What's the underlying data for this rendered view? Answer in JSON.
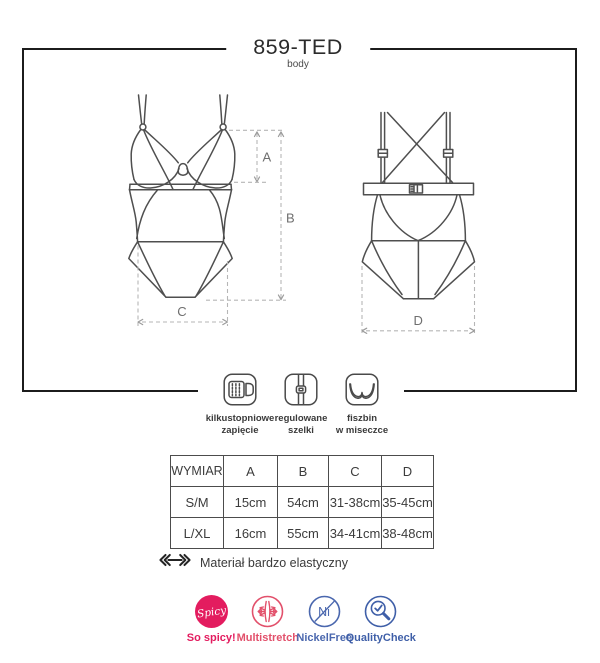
{
  "title": {
    "code": "859-TED",
    "subtitle": "body"
  },
  "dimensions": {
    "a": "A",
    "b": "B",
    "c": "C",
    "d": "D"
  },
  "features": [
    {
      "icon": "hook-eye-closure-icon",
      "line1": "kilkustopniowe",
      "line2": "zapięcie"
    },
    {
      "icon": "adjustable-straps-icon",
      "line1": "regulowane",
      "line2": "szelki"
    },
    {
      "icon": "underwire-cup-icon",
      "line1": "fiszbin",
      "line2": "w miseczce"
    }
  ],
  "size_table": {
    "headers": [
      "WYMIAR",
      "A",
      "B",
      "C",
      "D"
    ],
    "rows": [
      [
        "S/M",
        "15cm",
        "54cm",
        "31-38cm",
        "35-45cm"
      ],
      [
        "L/XL",
        "16cm",
        "55cm",
        "34-41cm",
        "38-48cm"
      ]
    ]
  },
  "material_note": "Materiał bardzo elastyczny",
  "badges": [
    {
      "id": "so-spicy",
      "circle_text": "Spicy",
      "label": "So spicy!",
      "color": "#e31c5f"
    },
    {
      "id": "multistretch",
      "label": "Multistretch",
      "color": "#e2506b"
    },
    {
      "id": "nickel-free",
      "circle_text": "Ni",
      "label": "NickelFree",
      "color": "#4a67ae"
    },
    {
      "id": "quality-check",
      "label": "QualityCheck",
      "color": "#3f5fa8"
    }
  ]
}
